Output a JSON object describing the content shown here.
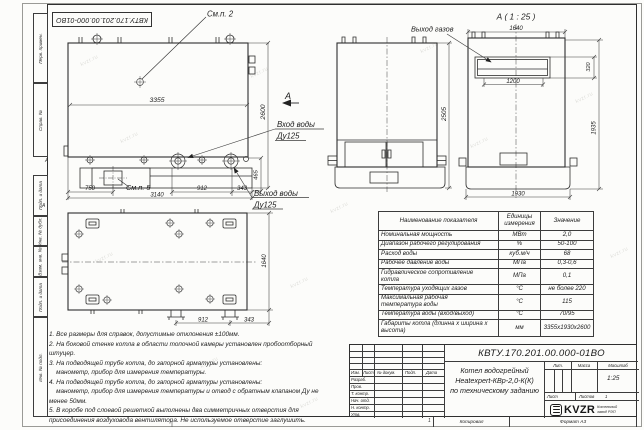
{
  "watermark": "kvzr.ru",
  "frame": {
    "sidebar_items": [
      "Перв. примен.",
      "Справ. №",
      "Подп. и дата",
      "Инв. № дубл.",
      "Взам. инв. №",
      "Подп. и дата",
      "Инв. № подл."
    ],
    "zone_a": "А",
    "zone_1": "1",
    "copied": "Копировал",
    "format": "Формат А3"
  },
  "doc": {
    "code": "КВТУ.170.201.00.000-01ВО",
    "name1": "Котел водогрейный",
    "name2": "Heatexpert-КВр-2,0-К(К)",
    "name3": "по техническому заданию",
    "lit_label": "Лит.",
    "mass_label": "Масса",
    "scale_label": "Масштаб",
    "scale": "1:25",
    "sheet_label": "Лист",
    "sheets_label": "Листов",
    "sheets": "1",
    "sig_header": [
      "Изм.",
      "Лист",
      "№ докум.",
      "Подп.",
      "Дата"
    ],
    "sig_rows": [
      "Разраб.",
      "Пров.",
      "Т. контр.",
      "Нач. отд.",
      "Н. контр.",
      "Утв."
    ],
    "logo_text": "KVZR",
    "logo_sub1": "Котельный",
    "logo_sub2": "завод РЭП"
  },
  "labels": {
    "see_p2": "См.п. 2",
    "see_p5": "См.п. 5",
    "section_mark": "А",
    "detail_title": "А ( 1 : 25 )",
    "gas_outlet": "Выход газов",
    "water_inlet": "Вход воды",
    "water_inlet_dn": "Ду125",
    "water_outlet": "Выход воды",
    "water_outlet_dn": "Ду125"
  },
  "dims": {
    "front_length": "3355",
    "front_height": "2600",
    "outlet_height": "465",
    "base_left": "750",
    "base_length": "3140",
    "front_912": "912",
    "front_343": "343",
    "side_height": "2505",
    "detail_width_top": "1640",
    "duct_width": "1200",
    "duct_height": "320",
    "detail_height": "1935",
    "detail_base": "1930",
    "top_width": "1640",
    "top_912": "912",
    "top_343": "343"
  },
  "table": {
    "headers": [
      "Наименование показателя",
      "Единицы\nизмерения",
      "Значение"
    ],
    "rows": [
      [
        "Номинальная мощность",
        "МВт",
        "2,0"
      ],
      [
        "Диапазон рабочего регулирования",
        "%",
        "50-100"
      ],
      [
        "Расход воды",
        "куб.м/ч",
        "68"
      ],
      [
        "Рабочее давление воды",
        "МПа",
        "0,3-0,6"
      ],
      [
        "Гидравлическое сопротивление\nкотла",
        "МПа",
        "0,1"
      ],
      [
        "Температура уходящих газов",
        "°С",
        "не более 220"
      ],
      [
        "Максимальная рабочая\nтемпература воды",
        "°С",
        "115"
      ],
      [
        "Температура воды (вход/выход)",
        "°С",
        "70/95"
      ],
      [
        "Габариты котла (длинна х ширина х\nвысота)",
        "мм",
        "3355х1930х2600"
      ]
    ]
  },
  "notes": {
    "lines": [
      "1. Все размеры для справок, допустимые отклонения ±100мм.",
      "2. На боковой стенке котла в области топочной камеры установлен пробоотборный",
      "штуцер.",
      "3. На подводящей трубе котла, до запорной арматуры установлены:",
      "    манометр, прибор для измерения температуры.",
      "4. На подводящей трубе котла, до запорной арматуры установлены:",
      "    манометр, прибор для измерения температуры и отвод с обратным клапаном Ду не",
      "менее 50мм.",
      "5. В коробе под слоевой решеткой выполнены два симметричных отверстия для",
      "присоединения воздуховода вентилятора. Не используемое отверстие заглушить."
    ]
  }
}
